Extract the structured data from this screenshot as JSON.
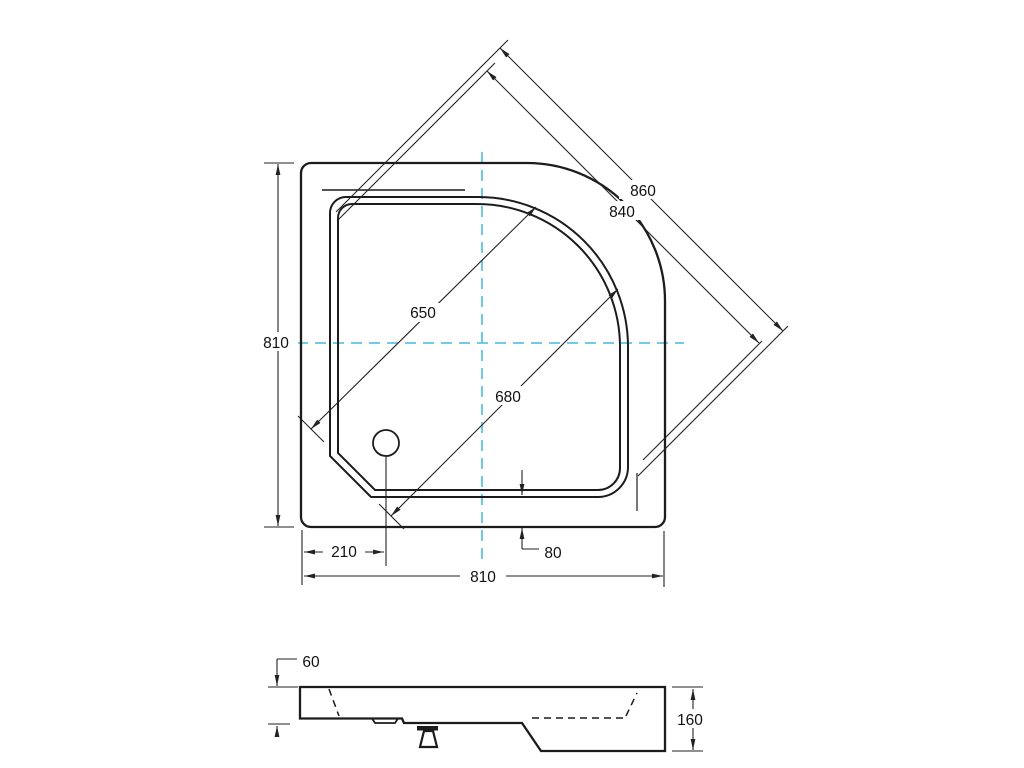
{
  "drawing": {
    "colors": {
      "line": "#1c1c1c",
      "dimension": "#222222",
      "centerline": "#5fc4e0",
      "background": "#ffffff",
      "text": "#111111"
    },
    "top_view": {
      "dimensions": {
        "outer_diagonal": "860",
        "inner_diagonal": "840",
        "rim_diagonal": "650",
        "basin_diagonal": "680",
        "overall_height": "810",
        "overall_width": "810",
        "drain_offset": "210",
        "rim_to_edge": "80"
      }
    },
    "side_view": {
      "dimensions": {
        "edge_height": "60",
        "total_height": "160"
      }
    }
  }
}
